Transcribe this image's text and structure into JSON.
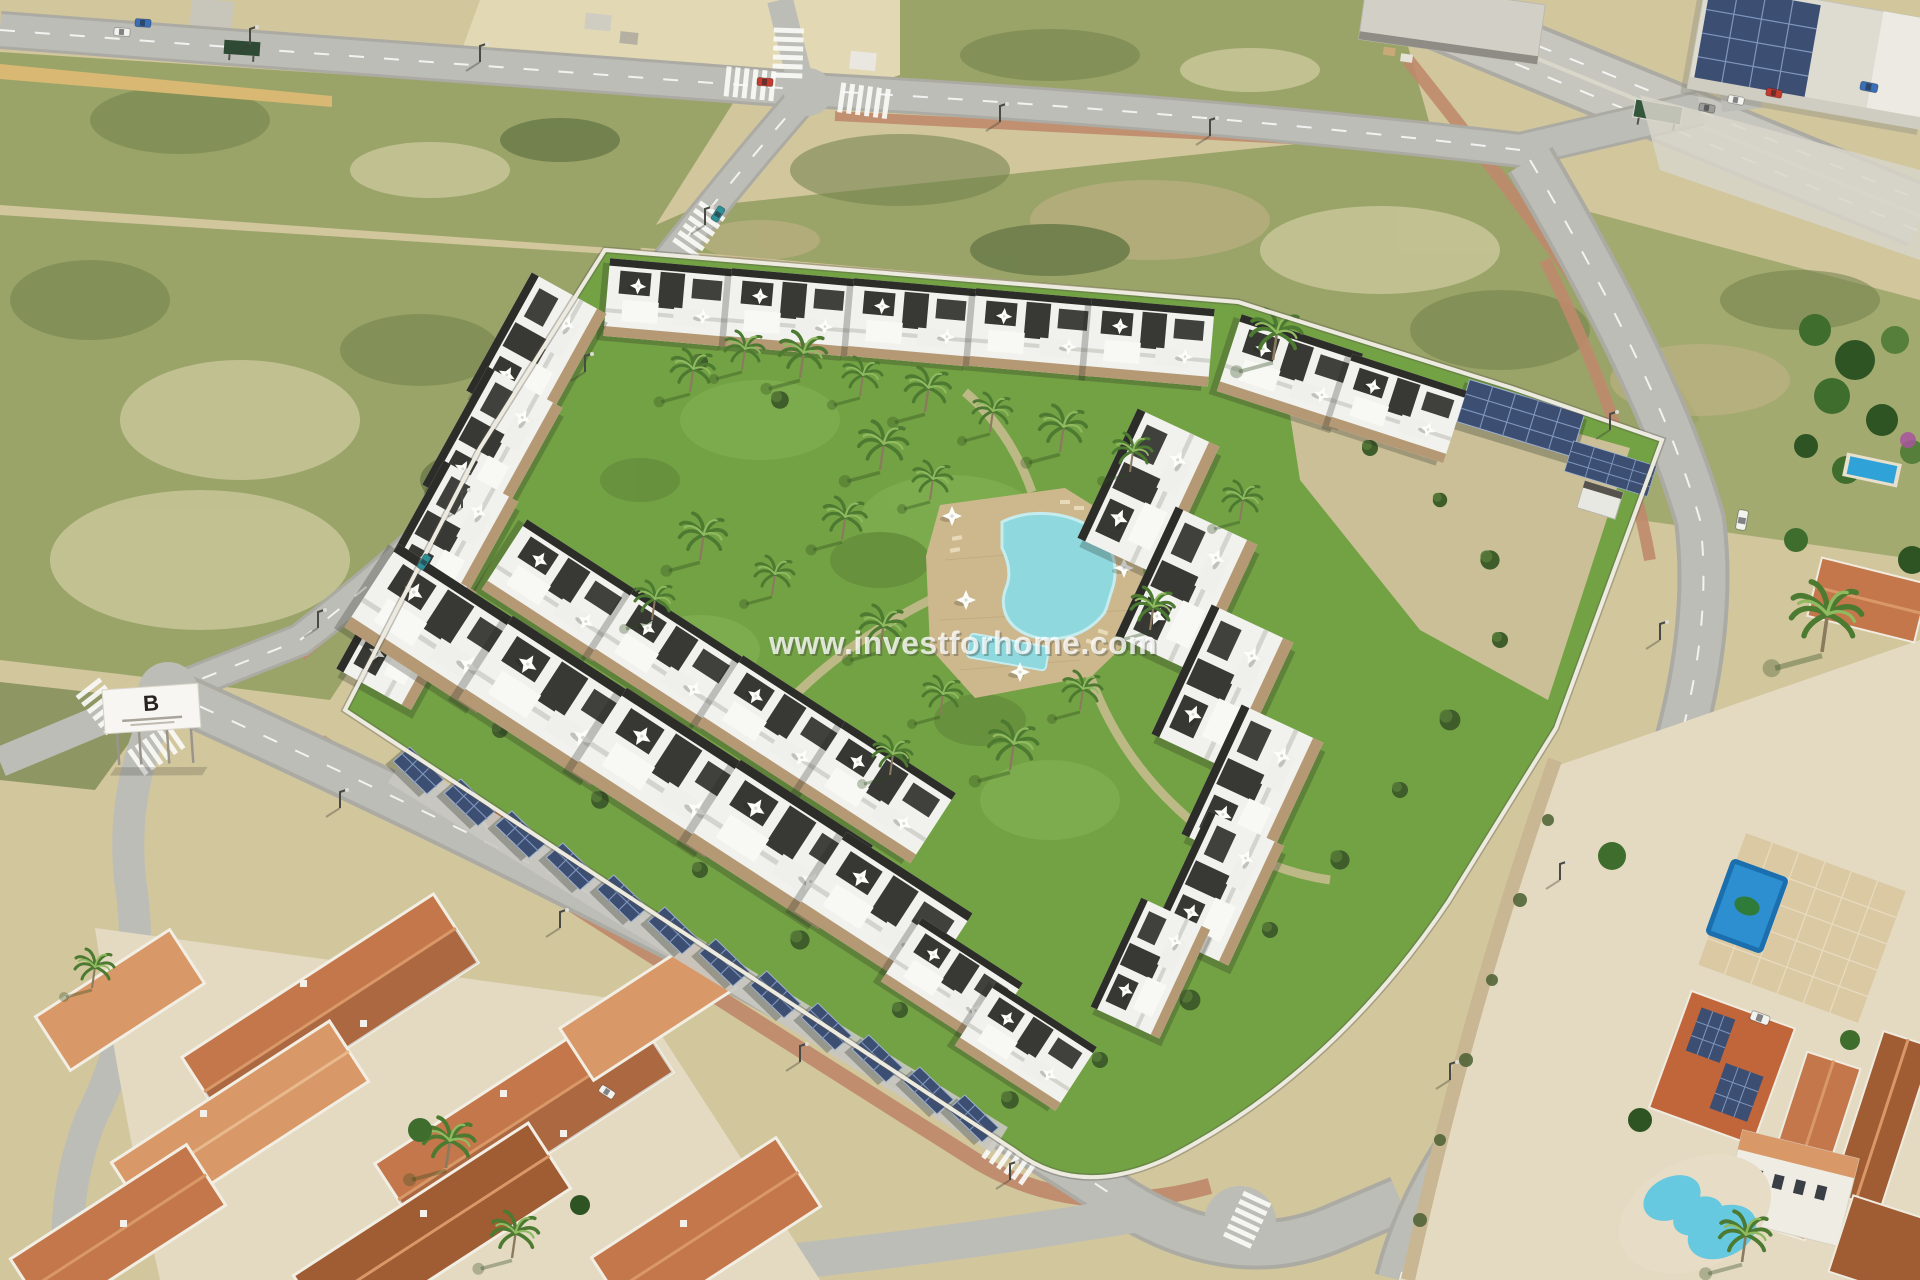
{
  "watermark": {
    "text": "www.investforhome.com"
  },
  "billboard": {
    "logo": "B"
  },
  "palette": {
    "sand": "#d2c69d",
    "sand-light": "#e2d8b4",
    "sand-deep": "#c4b489",
    "scrub": "#9aa468",
    "scrub-dark": "#71814a",
    "scrub-deep": "#526639",
    "asphalt": "#bdbdb7",
    "asphalt-dark": "#abaaa3",
    "road-line": "#ffffff",
    "walk-red": "#bf8a6d",
    "lawn": "#73a244",
    "lawn-light": "#86b556",
    "shrub": "#3e5d2a",
    "palm-green": "#4c7a31",
    "palm-light": "#90ba60",
    "bld-white": "#f1f1ed",
    "bld-dark": "#2c2c29",
    "stone": "#b0916a",
    "wall-white": "#edebe0",
    "pool": "#8fd9de",
    "deck": "#cdb88e",
    "terracotta": "#c4774a",
    "terracotta-dark": "#a05c33",
    "terracotta-light": "#d99868",
    "private-pool": "#2d8fd0",
    "kidney-pool": "#66c9e0",
    "solar": "#3c4f73",
    "solar-light": "#8096bd",
    "plaster": "#e4dac2",
    "sign-green": "#34573c",
    "car-red": "#c23b2e",
    "car-teal": "#2f8f96",
    "car-white": "#f2f2ee",
    "car-blue": "#3a6fb8",
    "car-gray": "#9b9b97"
  },
  "icons": {
    "palm-tree-icon": "radial frond starburst",
    "parasol-icon": "four-point white star",
    "solar-panel-icon": "blue grid panel",
    "streetlight-icon": "pole with lamp arm",
    "zebra-crossing-icon": "white stripe group"
  }
}
